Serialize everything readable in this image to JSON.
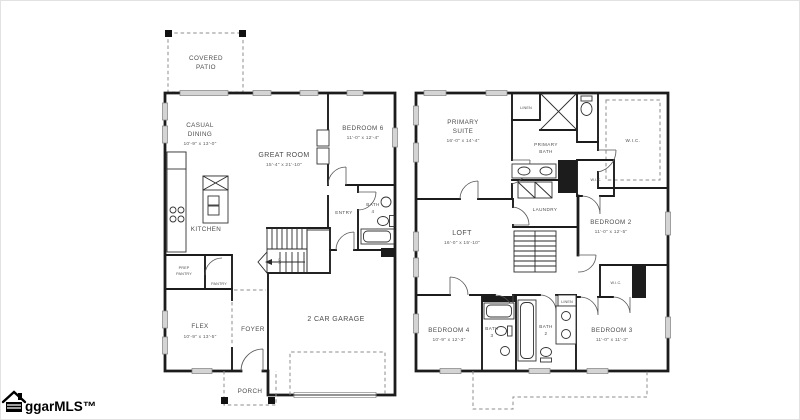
{
  "watermark": {
    "text": "ggarMLS™",
    "icon": "house-logo-icon"
  },
  "floor1": {
    "covered_patio_1": "COVERED",
    "covered_patio_2": "PATIO",
    "casual_dining_1": "CASUAL",
    "casual_dining_2": "DINING",
    "casual_dining_dims": "10'-9\" x 13'-0\"",
    "great_room": "GREAT ROOM",
    "great_room_dims": "15'-4\" x 21'-10\"",
    "bedroom6": "BEDROOM 6",
    "bedroom6_dims": "11'-0\" x 12'-4\"",
    "entry": "ENTRY",
    "bath4_1": "BATH",
    "bath4_2": "4",
    "kitchen": "KITCHEN",
    "prep_pantry_1": "PREP",
    "prep_pantry_2": "PANTRY",
    "pantry": "PANTRY",
    "flex": "FLEX",
    "flex_dims": "10'-9\" x 13'-5\"",
    "foyer": "FOYER",
    "garage": "2 CAR GARAGE",
    "porch": "PORCH",
    "stairs_up": "UP"
  },
  "floor2": {
    "primary_suite_1": "PRIMARY",
    "primary_suite_2": "SUITE",
    "primary_suite_dims": "16'-0\" x 14'-4\"",
    "linen_top": "LINEN",
    "primary_bath_1": "PRIMARY",
    "primary_bath_2": "BATH",
    "wic_large": "W.I.C.",
    "wic_small": "W.I.C.",
    "laundry": "LAUNDRY",
    "loft": "LOFT",
    "loft_dims": "16'-0\" x 15'-10\"",
    "bedroom2": "BEDROOM 2",
    "bedroom2_dims": "11'-0\" x 12'-5\"",
    "wic_bedroom3": "W.I.C.",
    "bedroom4": "BEDROOM 4",
    "bedroom4_dims": "10'-9\" x 12'-3\"",
    "bath3_1": "BATH",
    "bath3_2": "3",
    "bath2_1": "BATH",
    "bath2_2": "2",
    "linen_bath2": "LINEN",
    "bedroom3": "BEDROOM 3",
    "bedroom3_dims": "11'-0\" x 11'-3\""
  }
}
